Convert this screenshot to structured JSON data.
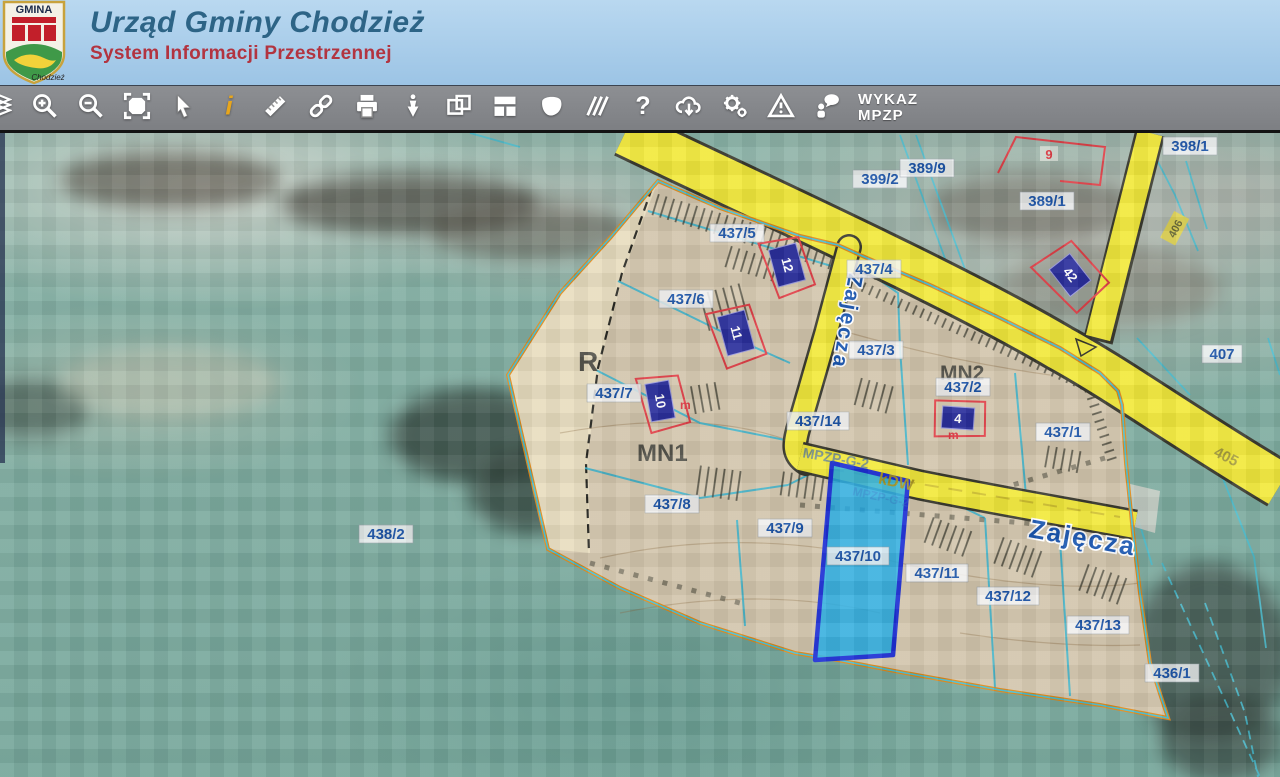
{
  "header": {
    "title": "Urząd Gminy Chodzież",
    "subtitle": "System Informacji Przestrzennej",
    "logo": {
      "top": "GMINA",
      "bottom": "Chodzież"
    }
  },
  "toolbar": {
    "items": [
      "layers",
      "zoom-in",
      "zoom-out",
      "full-extent",
      "select-pointer",
      "identify-info",
      "measure",
      "link",
      "print",
      "location-pin",
      "select-region",
      "layout",
      "polygon-select",
      "hatch",
      "help",
      "download",
      "settings",
      "report-problem",
      "contact",
      "wykaz-mpzp"
    ],
    "wykaz": {
      "line1": "WYKAZ",
      "line2": "MPZP"
    }
  },
  "map": {
    "zones": {
      "r": "R",
      "mn1": "MN1",
      "mn2": "MN2"
    },
    "streets": {
      "zajecza_vertical": "Zajęcza",
      "zajecza_horizontal": "Zajęcza"
    },
    "roads": {
      "kdw": "kDW",
      "mpzp_line": "MPZP-G-2",
      "n405": "405",
      "n406": "406"
    },
    "parcels": {
      "p398_1": "398/1",
      "p399_2": "399/2",
      "p389_9": "389/9",
      "p389_1": "389/1",
      "p407": "407",
      "p405_l": "405",
      "p437_5": "437/5",
      "p437_4": "437/4",
      "p437_6": "437/6",
      "p437_3": "437/3",
      "p437_2": "437/2",
      "p437_7": "437/7",
      "p437_1": "437/1",
      "p437_14": "437/14",
      "p437_8": "437/8",
      "p437_9": "437/9",
      "p437_10": "437/10",
      "p437_11": "437/11",
      "p437_12": "437/12",
      "p437_13": "437/13",
      "p438_2": "438/2",
      "p436_1": "436/1"
    },
    "buildings": {
      "b12": "12",
      "b11": "11",
      "b10": "10",
      "b4": "4",
      "b42": "42",
      "b9": "9",
      "m1": "m",
      "m2": "m"
    },
    "colors": {
      "plan_fill": "#d4c7ae",
      "zone_r_fill": "#e9dec0",
      "road_yellow": "#f2e93c",
      "boundary_orange": "#e0891a",
      "parcel_line_cyan": "#3db4cc",
      "highlight_fill": "#28aee6",
      "highlight_border": "#1e2fd4",
      "label_blue": "#1d55a8",
      "building_navy": "#2b2f9c",
      "building_outline_red": "#e04048"
    }
  }
}
